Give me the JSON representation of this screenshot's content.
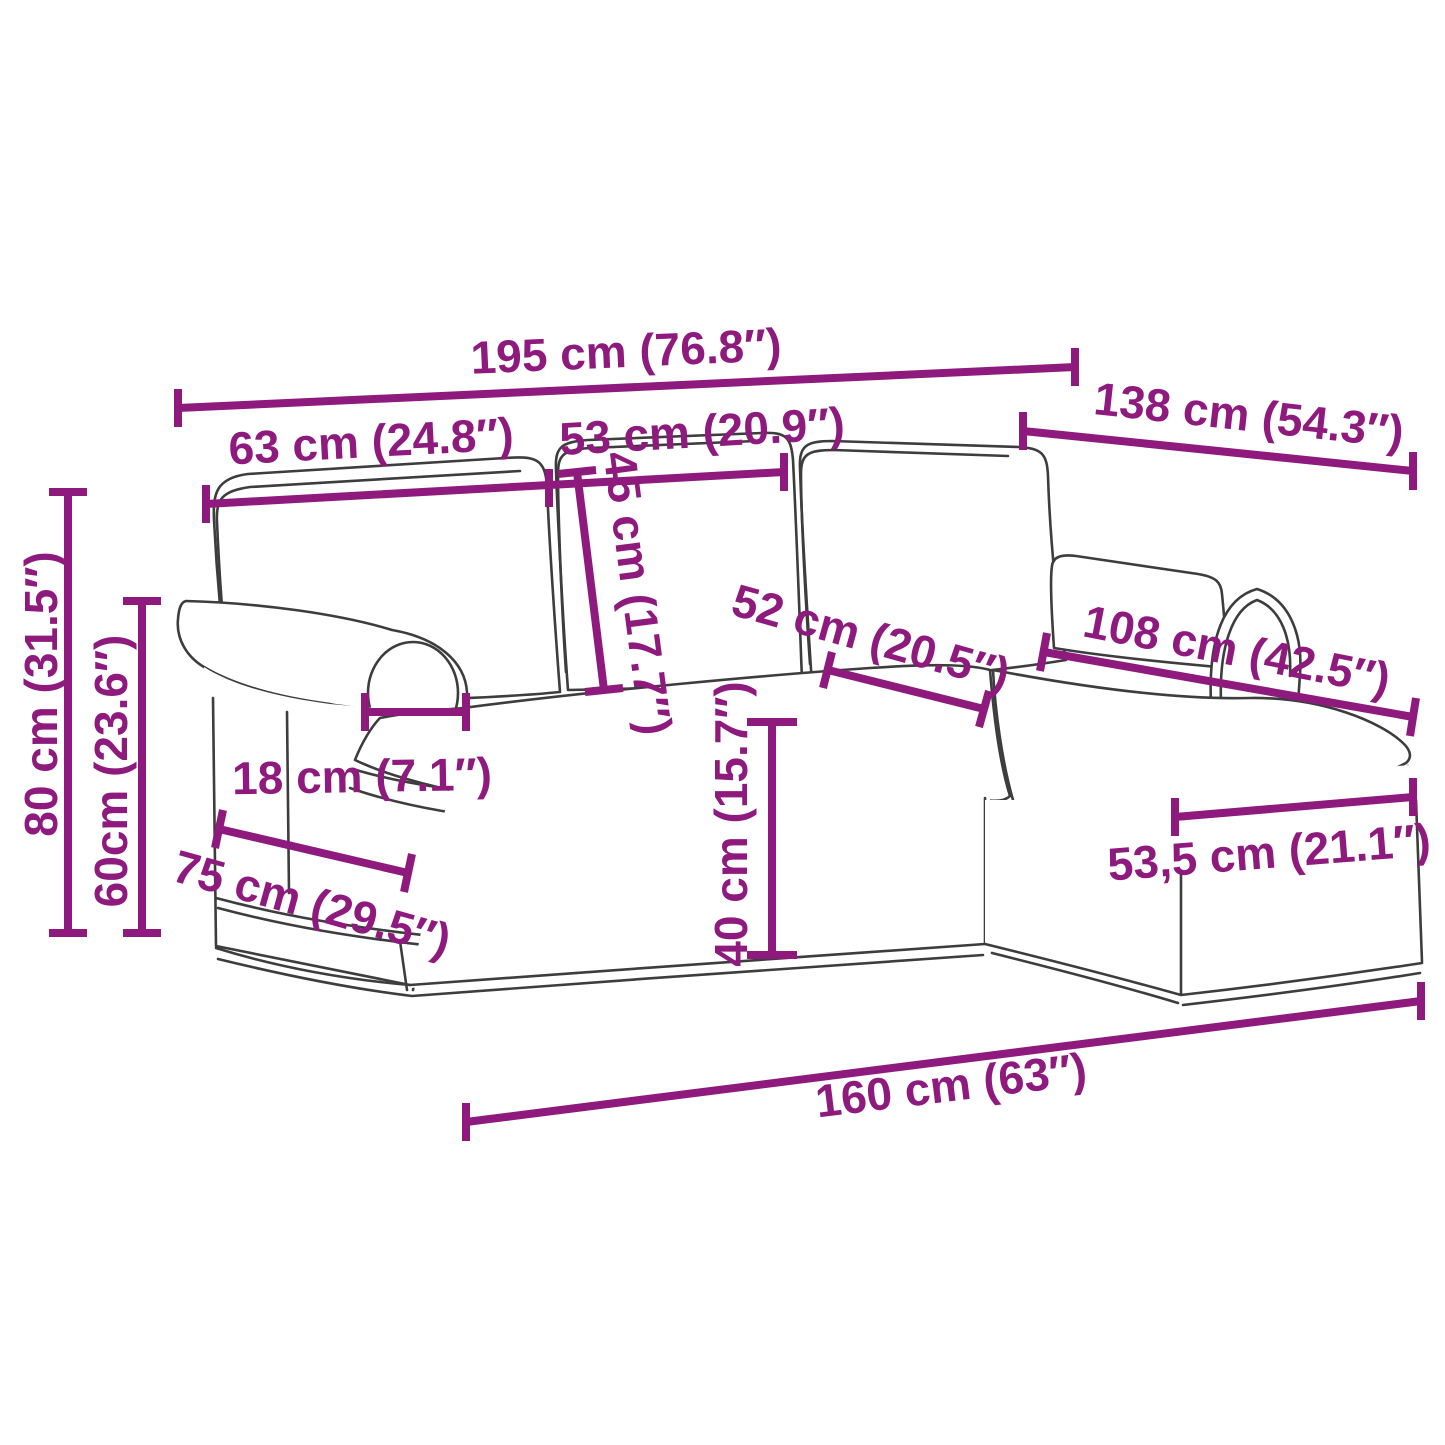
{
  "diagram": {
    "name": "sofa-with-chaise-longue-dimension-diagram",
    "accent_color": "#8E1A7D",
    "outline_color": "#3D3D3D",
    "dimensions": {
      "overall_width": "195 cm (76.8″)",
      "left_section_width": "63 cm (24.8″)",
      "middle_section_width": "53 cm (20.9″)",
      "depth_with_chaise": "138 cm (54.3″)",
      "overall_height": "80 cm (31.5″)",
      "armrest_height": "60cm (23.6″)",
      "back_cushion_height": "45 cm (17.7″)",
      "seat_depth": "52 cm (20.5″)",
      "chaise_length": "108 cm (42.5″)",
      "armrest_width": "18 cm (7.1″)",
      "base_depth": "75 cm (29.5″)",
      "seat_height": "40 cm (15.7″)",
      "chaise_width": "53,5 cm (21.1″)",
      "front_width": "160 cm (63″)"
    }
  }
}
